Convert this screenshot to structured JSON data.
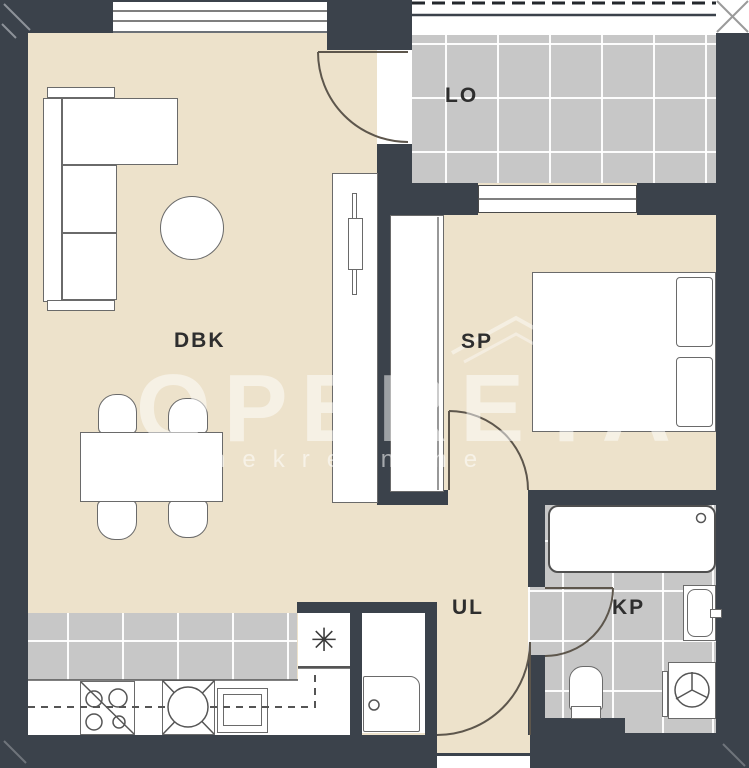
{
  "plan": {
    "title": "apartment-floor-plan",
    "watermark": {
      "brand": "OPERETA",
      "subtitle": "nekretnine"
    },
    "rooms": [
      {
        "id": "dbk",
        "label": "DBK",
        "name": "living-dining-kitchen"
      },
      {
        "id": "lo",
        "label": "LO",
        "name": "loggia"
      },
      {
        "id": "sp",
        "label": "SP",
        "name": "bedroom"
      },
      {
        "id": "ul",
        "label": "UL",
        "name": "hallway"
      },
      {
        "id": "kp",
        "label": "KP",
        "name": "bathroom"
      }
    ],
    "symbols": {
      "asterisk": "✳"
    },
    "colors": {
      "wall": "#3b424b",
      "floor": "#ede2cb",
      "tile": "#c7c7c7",
      "furniture_outline": "#6a6a6a",
      "door_arc": "#5d564c"
    }
  }
}
